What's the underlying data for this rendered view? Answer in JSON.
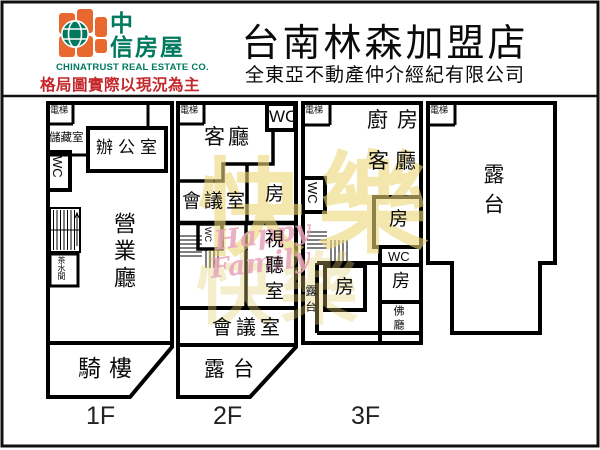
{
  "header": {
    "logo": {
      "brand_zh_line1": "中",
      "brand_zh_line2": "信房屋",
      "brand_en": "CHINATRUST REAL ESTATE CO.",
      "disclaimer": "格局圖實際以現況為主",
      "orange": "#e8682f",
      "green": "#00795f",
      "red": "#c3272b"
    },
    "title": "台南林森加盟店",
    "subtitle": "全東亞不動產仲介經紀有限公司"
  },
  "watermark": {
    "char1": "快",
    "char2": "樂",
    "ghost": "快樂",
    "script_line1": "Happy",
    "script_line2": "Family",
    "yellow": "#ecd87a",
    "pink": "#e8a3ba"
  },
  "floors": {
    "f1": {
      "label": "1F",
      "rooms": {
        "elevator": "電梯",
        "storage": "儲藏室",
        "office": "辦公室",
        "wc": "WC",
        "tea": "茶水間",
        "hall": "營業廳",
        "arcade": "騎樓"
      }
    },
    "f2": {
      "label": "2F",
      "rooms": {
        "elevator": "電梯",
        "living": "客廳",
        "wc_top": "WC",
        "meeting_upper": "會議室",
        "room": "房",
        "wc_stairs": "WC",
        "av_room": "視聽室",
        "meeting_lower": "會議室",
        "terrace": "露台"
      }
    },
    "f3": {
      "label": "3F",
      "rooms": {
        "elevator": "電梯",
        "kitchen": "廚房",
        "living": "客廳",
        "wc_left": "WC",
        "terrace_side": "露台",
        "room_top": "房",
        "wc_right": "WC",
        "room_right": "房",
        "room_left": "房",
        "buddha": "佛廳"
      }
    },
    "roof": {
      "rooms": {
        "elevator": "電梯",
        "terrace": "露台"
      }
    }
  }
}
